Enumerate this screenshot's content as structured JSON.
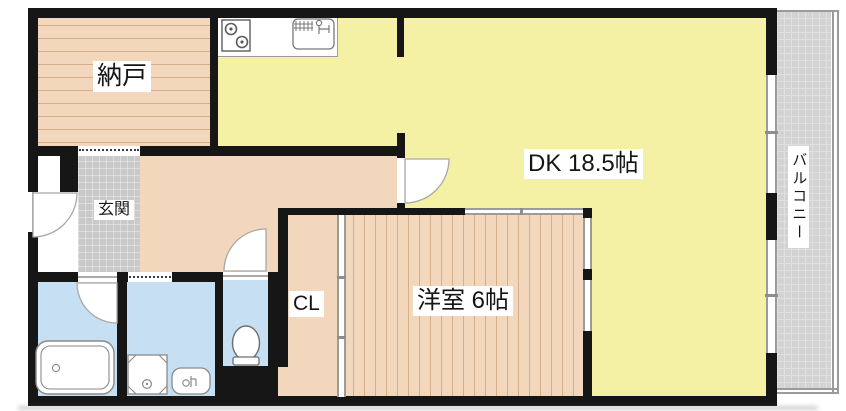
{
  "rooms": {
    "nando": "納戸",
    "genkan": "玄関",
    "dk": "DK 18.5帖",
    "western": "洋室 6帖",
    "closet": "CL",
    "balcony": "バルコニー"
  },
  "fixtures": [
    "stove-icon",
    "sink-icon",
    "bathtub-icon",
    "washing-machine-pan-icon",
    "washbasin-icon",
    "toilet-icon",
    "door-swing-arc",
    "sliding-window",
    "accordion-door-dotted"
  ],
  "colors": {
    "wall": "#161616",
    "dk_floor": "#f5f1a4",
    "wood_floor": "#f2d7bc",
    "wet_area_floor": "#c6dff2",
    "entrance_tile": "#c9c9c9",
    "balcony_floor": "#d3d3d3"
  }
}
